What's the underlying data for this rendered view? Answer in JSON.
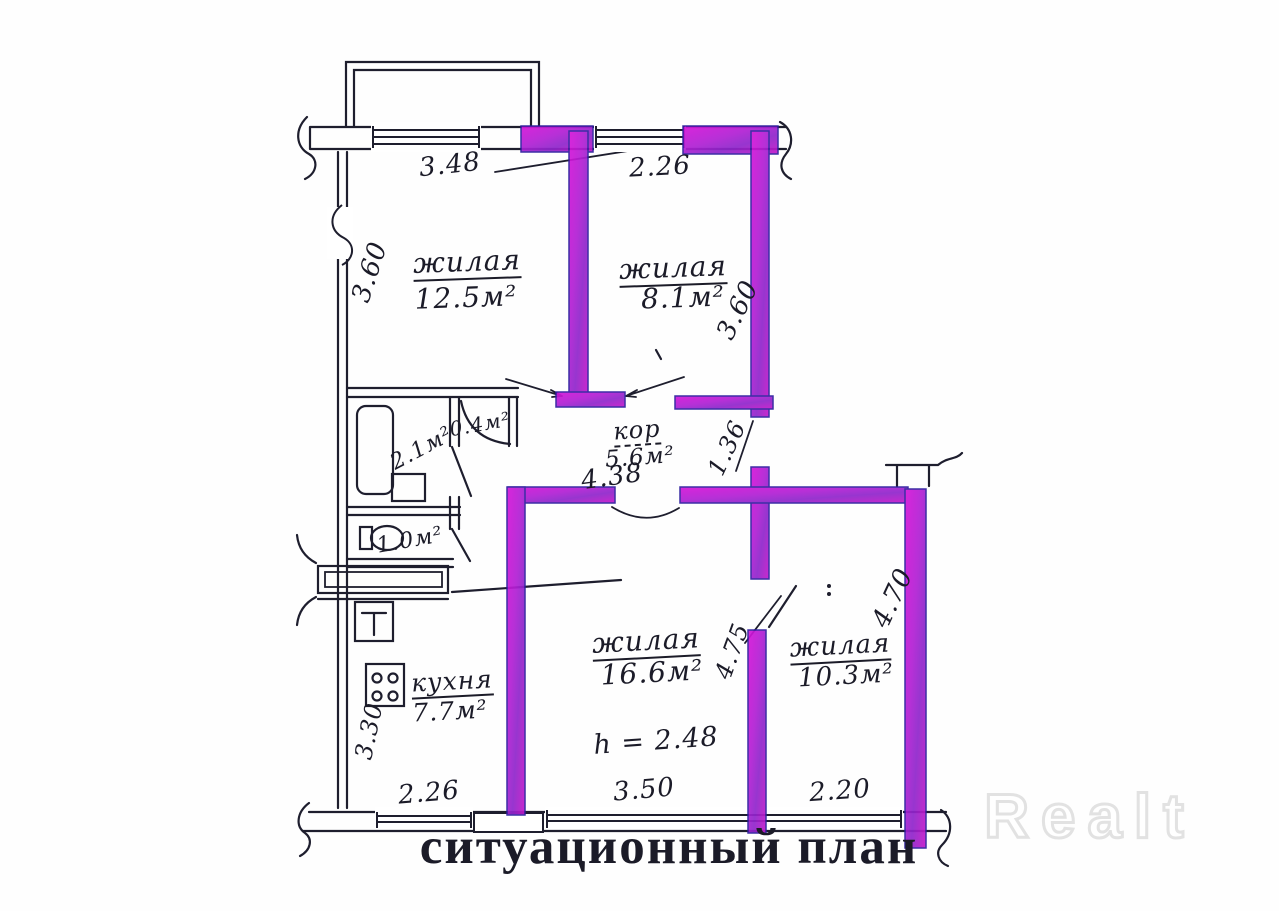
{
  "document": {
    "caption": "ситуационный план",
    "watermark": "Realt"
  },
  "rooms": {
    "living1": {
      "name": "жилая",
      "area": "12.5м²",
      "width": "3.48",
      "depth": "3.60"
    },
    "living2": {
      "name": "жилая",
      "area": "8.1м²",
      "width": "2.26",
      "depth": "3.60"
    },
    "living3": {
      "name": "жилая",
      "area": "16.6м²",
      "ceiling_height": "h = 2.48",
      "width": "3.50",
      "depth": "4.75"
    },
    "living4": {
      "name": "жилая",
      "area": "10.3м²",
      "width": "2.20",
      "depth": "4.70"
    },
    "kitchen": {
      "name": "кухня",
      "area": "7.7м²",
      "width": "2.26",
      "depth": "3.30"
    },
    "corridor": {
      "name": "кор",
      "area": "5.6м²",
      "length": "4.38",
      "nook_depth": "1.36"
    },
    "bathroom": {
      "area": "2.1м²"
    },
    "closet": {
      "area": "0.4м²"
    },
    "wc": {
      "area": "1.0м²"
    }
  },
  "colors": {
    "wall_highlight": "#bf1dce",
    "ink": "#1b1b28",
    "paper": "#fefefe",
    "watermark_gray": "#e2e2e2"
  }
}
